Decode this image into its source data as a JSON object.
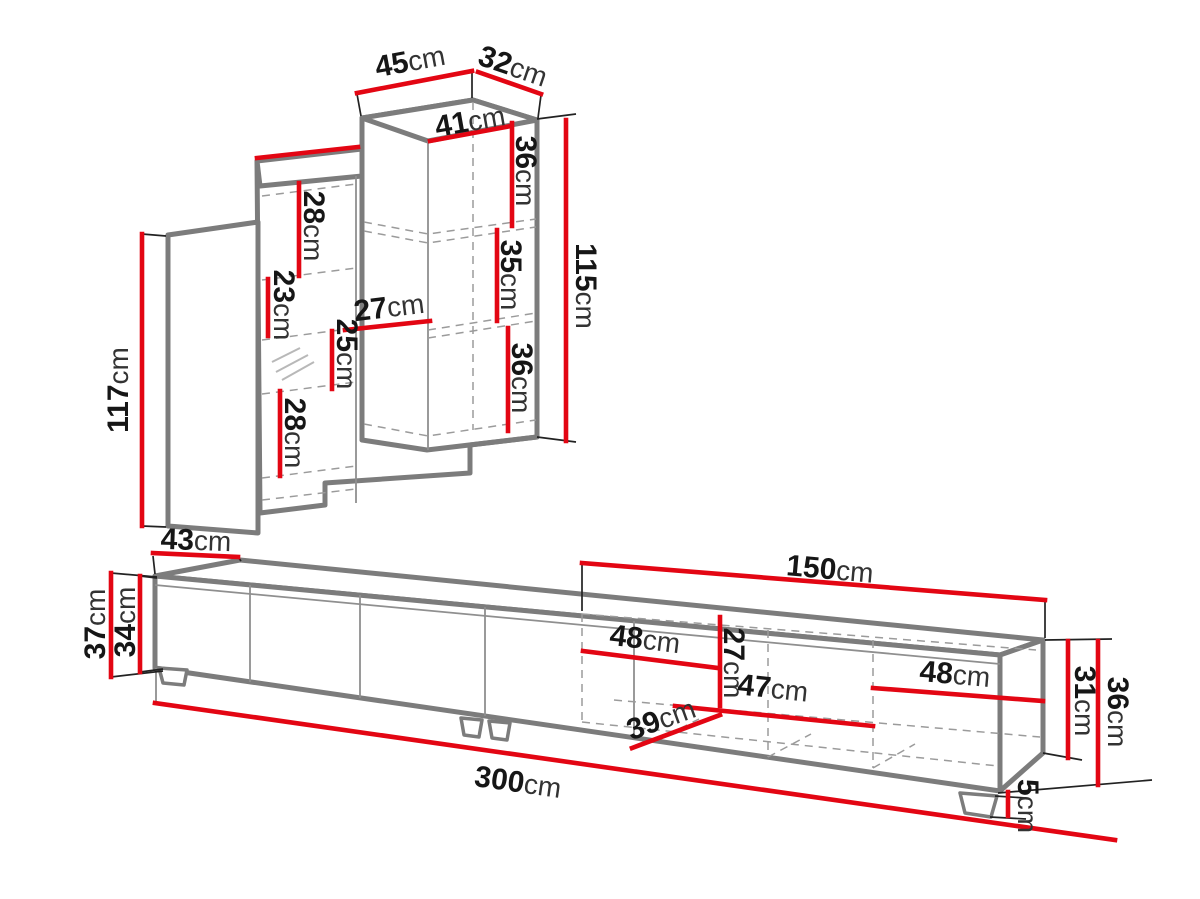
{
  "page": {
    "type": "furniture-dimension-diagram",
    "background": "#ffffff"
  },
  "colors": {
    "dimension_line": "#e30613",
    "furniture_outline": "#7c7c7c",
    "label_text": "#161616",
    "unit_text": "#333333"
  },
  "unit": "cm",
  "wall_unit": {
    "name": "wall cabinet assembly",
    "dims": [
      {
        "name": "top-width",
        "value": "45",
        "unit": "cm"
      },
      {
        "name": "top-depth",
        "value": "32",
        "unit": "cm"
      },
      {
        "name": "cabinet-inner-width",
        "value": "41",
        "unit": "cm"
      },
      {
        "name": "cabinet-top-section-height",
        "value": "36",
        "unit": "cm"
      },
      {
        "name": "cabinet-middle-section-height",
        "value": "35",
        "unit": "cm"
      },
      {
        "name": "cabinet-bottom-section-height",
        "value": "36",
        "unit": "cm"
      },
      {
        "name": "cabinet-height",
        "value": "115",
        "unit": "cm"
      },
      {
        "name": "shelf-top-section-height",
        "value": "28",
        "unit": "cm"
      },
      {
        "name": "shelf-second-section-height",
        "value": "23",
        "unit": "cm"
      },
      {
        "name": "shelf-third-section-height",
        "value": "25",
        "unit": "cm"
      },
      {
        "name": "shelf-bottom-section-height",
        "value": "28",
        "unit": "cm"
      },
      {
        "name": "shelf-inner-width",
        "value": "27",
        "unit": "cm"
      },
      {
        "name": "door-height",
        "value": "117",
        "unit": "cm"
      }
    ]
  },
  "tv_stand": {
    "name": "tv stand",
    "dims": [
      {
        "name": "depth",
        "value": "43",
        "unit": "cm"
      },
      {
        "name": "total-height",
        "value": "37",
        "unit": "cm"
      },
      {
        "name": "body-height",
        "value": "34",
        "unit": "cm"
      },
      {
        "name": "open-section-width",
        "value": "150",
        "unit": "cm"
      },
      {
        "name": "left-compartment-width",
        "value": "48",
        "unit": "cm"
      },
      {
        "name": "inner-height",
        "value": "27",
        "unit": "cm"
      },
      {
        "name": "middle-compartment-width",
        "value": "47",
        "unit": "cm"
      },
      {
        "name": "right-compartment-width",
        "value": "48",
        "unit": "cm"
      },
      {
        "name": "inner-depth",
        "value": "39",
        "unit": "cm"
      },
      {
        "name": "total-width",
        "value": "300",
        "unit": "cm"
      },
      {
        "name": "right-inner-height",
        "value": "31",
        "unit": "cm"
      },
      {
        "name": "right-end-height",
        "value": "36",
        "unit": "cm"
      },
      {
        "name": "feet-height",
        "value": "5",
        "unit": "cm"
      }
    ]
  }
}
